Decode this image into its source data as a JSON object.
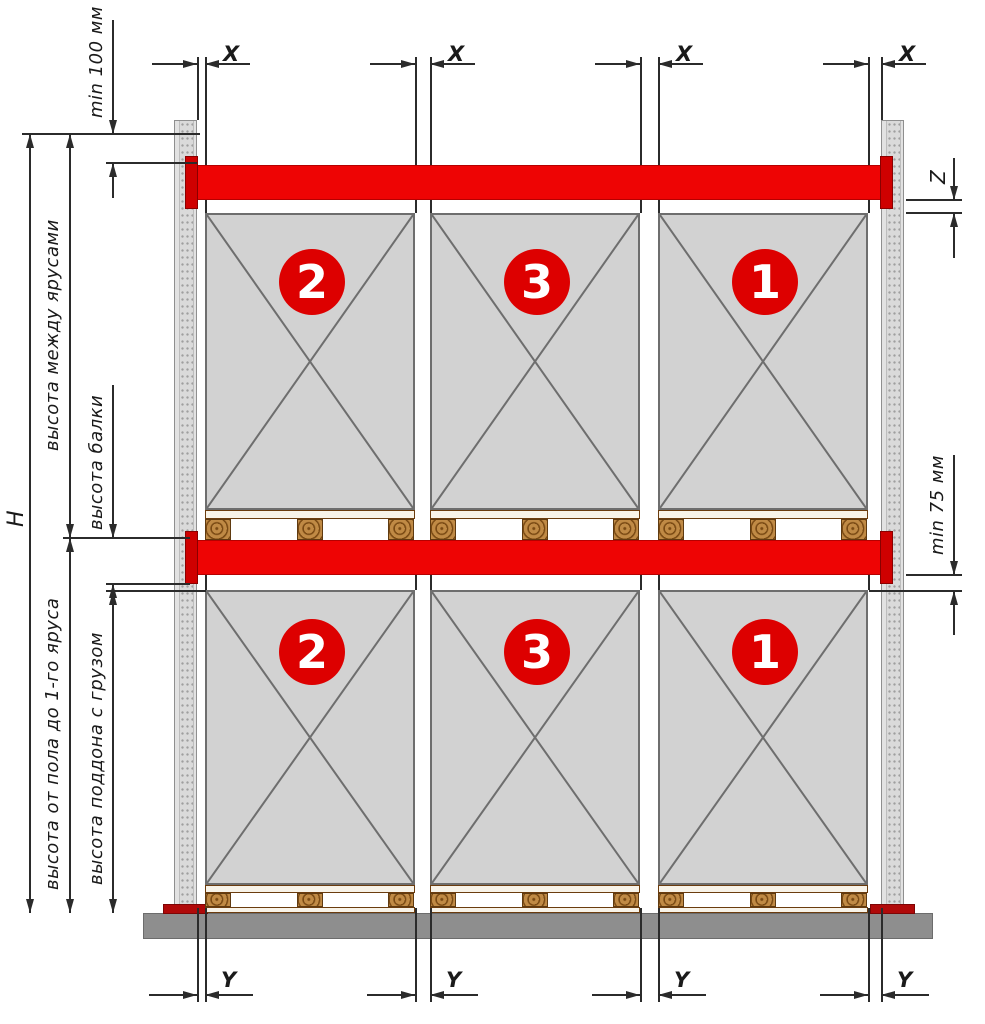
{
  "diagram": {
    "title_hint": "pallet-rack-elevation-drawing",
    "left_dims": {
      "total_height": "H",
      "min_top_clearance": "min 100 мм",
      "between_tiers": "высота между ярусами",
      "beam_height": "высота балки",
      "floor_to_first_tier": "высота от пола до 1-го яруса",
      "pallet_with_load": "высота поддона с грузом"
    },
    "right_dims": {
      "beam_to_load_gap": "Z",
      "min_load_clearance": "min 75 мм"
    },
    "top_dim_label": "X",
    "bottom_dim_label": "Y",
    "tiers": {
      "upper_loads": [
        "2",
        "3",
        "1"
      ],
      "lower_loads": [
        "2",
        "3",
        "1"
      ]
    },
    "colors": {
      "beam_red": "#ee0404",
      "connector_red": "#cf0000",
      "base_plate_red": "#b00909",
      "badge_red": "#dd0000",
      "load_gray": "#d2d2d2",
      "floor_gray": "#8e8e8e",
      "upright_gray": "#e2e2e2",
      "pallet_wood": "#c08a45",
      "line_color": "#2b2b2b"
    }
  }
}
